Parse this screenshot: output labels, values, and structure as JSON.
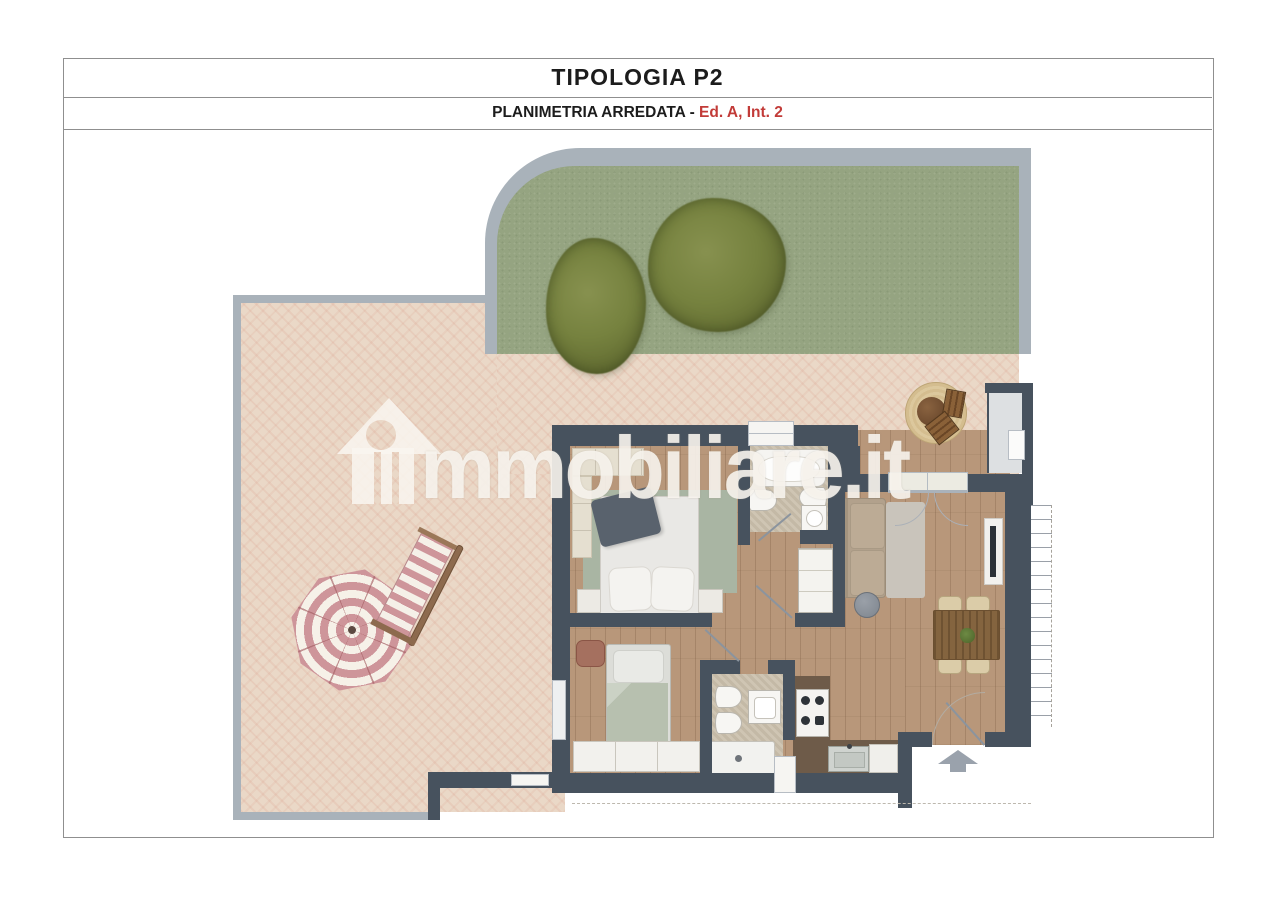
{
  "header": {
    "title": "TIPOLOGIA P2",
    "subtitle_prefix": "PLANIMETRIA ARREDATA - ",
    "subtitle_highlight": "Ed. A, Int. 2"
  },
  "watermark": {
    "brand": "immobiliare.it",
    "text_after_logo": "mmobiliare.it"
  },
  "colors": {
    "title_black": "#1c1c1c",
    "accent_red": "#c23b38",
    "line": "#8f8f8f",
    "wall": "#47525e",
    "border_gray": "#a9b2ba",
    "grass": "#95a481",
    "tree": "#76823f",
    "tile": "#ead8c7",
    "wood": "#b8977a",
    "bath_floor": "#cfc5b3",
    "entry_floor": "#dde0e2",
    "counter": "#6e5b49",
    "sofa": "#b2a18c",
    "rug_sage": "#a9b5a3",
    "bed_sage": "#b7c0af",
    "cream": "#e5dfd0",
    "umbrella_pink": "#ce959a",
    "jute": "#d4bd8f",
    "arrow": "#9aa2ac",
    "stair_line": "#9aa0a8"
  }
}
